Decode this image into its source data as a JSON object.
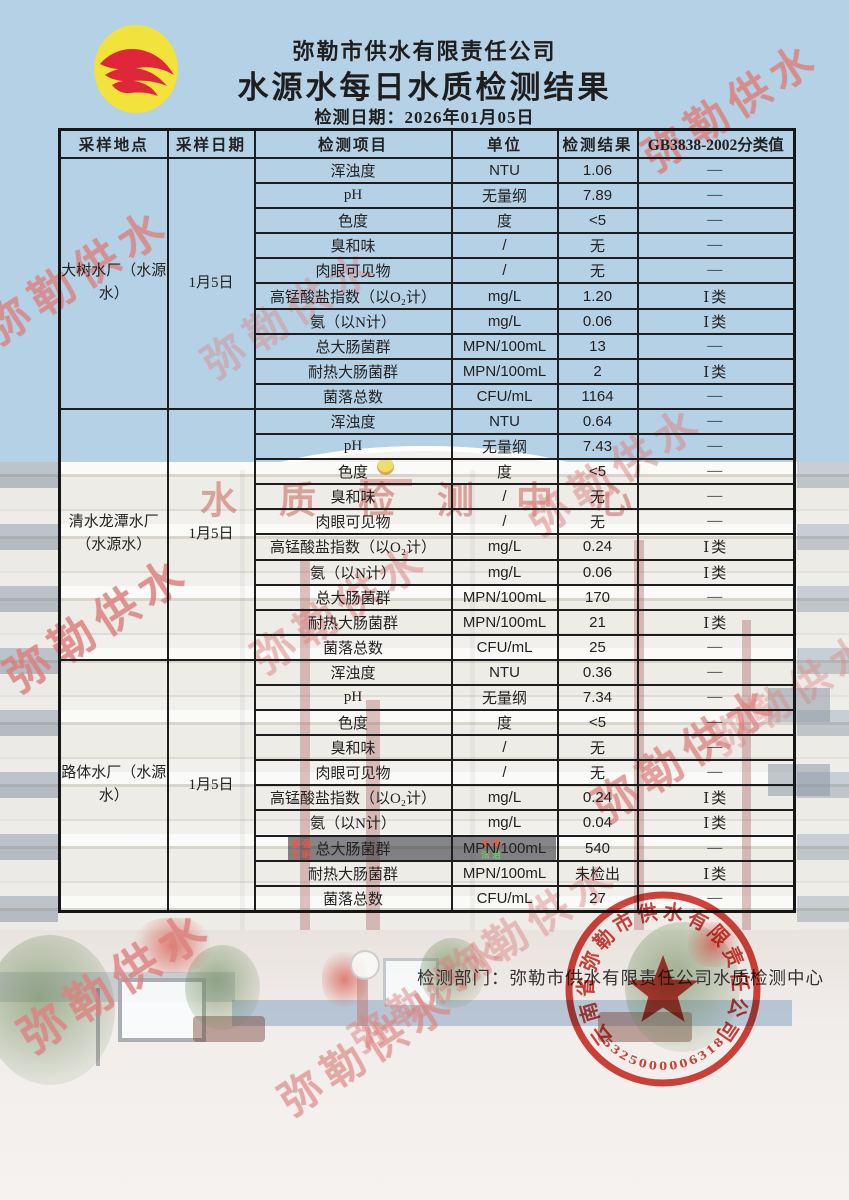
{
  "header": {
    "company": "弥勒市供水有限责任公司",
    "title": "水源水每日水质检测结果",
    "date_line": "检测日期：2026年01月05日"
  },
  "table": {
    "columns": [
      "采样地点",
      "采样日期",
      "检测项目",
      "单位",
      "检测结果",
      "GB3838-2002分类值"
    ],
    "sections": [
      {
        "location": "大树水厂（水源水）",
        "date": "1月5日",
        "rows": [
          [
            "浑浊度",
            "NTU",
            "1.06",
            "—"
          ],
          [
            "pH",
            "无量纲",
            "7.89",
            "—"
          ],
          [
            "色度",
            "度",
            "<5",
            "—"
          ],
          [
            "臭和味",
            "/",
            "无",
            "—"
          ],
          [
            "肉眼可见物",
            "/",
            "无",
            "—"
          ],
          [
            "高锰酸盐指数（以O₂计）",
            "mg/L",
            "1.20",
            "Ⅰ类"
          ],
          [
            "氨（以N计）",
            "mg/L",
            "0.06",
            "Ⅰ类"
          ],
          [
            "总大肠菌群",
            "MPN/100mL",
            "13",
            "—"
          ],
          [
            "耐热大肠菌群",
            "MPN/100mL",
            "2",
            "Ⅰ类"
          ],
          [
            "菌落总数",
            "CFU/mL",
            "1164",
            "—"
          ]
        ]
      },
      {
        "location": "清水龙潭水厂（水源水）",
        "date": "1月5日",
        "rows": [
          [
            "浑浊度",
            "NTU",
            "0.64",
            "—"
          ],
          [
            "pH",
            "无量纲",
            "7.43",
            "—"
          ],
          [
            "色度",
            "度",
            "<5",
            "—"
          ],
          [
            "臭和味",
            "/",
            "无",
            "—"
          ],
          [
            "肉眼可见物",
            "/",
            "无",
            "—"
          ],
          [
            "高锰酸盐指数（以O₂计）",
            "mg/L",
            "0.24",
            "Ⅰ类"
          ],
          [
            "氨（以N计）",
            "mg/L",
            "0.06",
            "Ⅰ类"
          ],
          [
            "总大肠菌群",
            "MPN/100mL",
            "170",
            "—"
          ],
          [
            "耐热大肠菌群",
            "MPN/100mL",
            "21",
            "Ⅰ类"
          ],
          [
            "菌落总数",
            "CFU/mL",
            "25",
            "—"
          ]
        ]
      },
      {
        "location": "路体水厂（水源水）",
        "date": "1月5日",
        "rows": [
          [
            "浑浊度",
            "NTU",
            "0.36",
            "—"
          ],
          [
            "pH",
            "无量纲",
            "7.34",
            "—"
          ],
          [
            "色度",
            "度",
            "<5",
            "—"
          ],
          [
            "臭和味",
            "/",
            "无",
            "—"
          ],
          [
            "肉眼可见物",
            "/",
            "无",
            "—"
          ],
          [
            "高锰酸盐指数（以O₂计）",
            "mg/L",
            "0.24",
            "Ⅰ类"
          ],
          [
            "氨（以N计）",
            "mg/L",
            "0.04",
            "Ⅰ类"
          ],
          [
            "总大肠菌群",
            "MPN/100mL",
            "540",
            "—"
          ],
          [
            "耐热大肠菌群",
            "MPN/100mL",
            "未检出",
            "Ⅰ类"
          ],
          [
            "菌落总数",
            "CFU/mL",
            "27",
            "—"
          ]
        ]
      }
    ]
  },
  "footer": {
    "department_line": "检测部门：弥勒市供水有限责任公司水质检测中心"
  },
  "seal": {
    "company": "云南省弥勒市供水有限责任公司",
    "number": "5325000006318"
  },
  "watermark": {
    "text": "弥勒供水"
  },
  "background": {
    "sign_text": "水质检测中心",
    "led_words": [
      "富强",
      "文明",
      "平等",
      "法治"
    ]
  },
  "colors": {
    "sky_blue": "#b5d1e6",
    "border_black": "#1c1c1c",
    "seal_red": "#d02a20",
    "watermark_pink": "#df8f8e",
    "logo_yellow": "#f2e23c",
    "logo_red": "#e0263b"
  }
}
